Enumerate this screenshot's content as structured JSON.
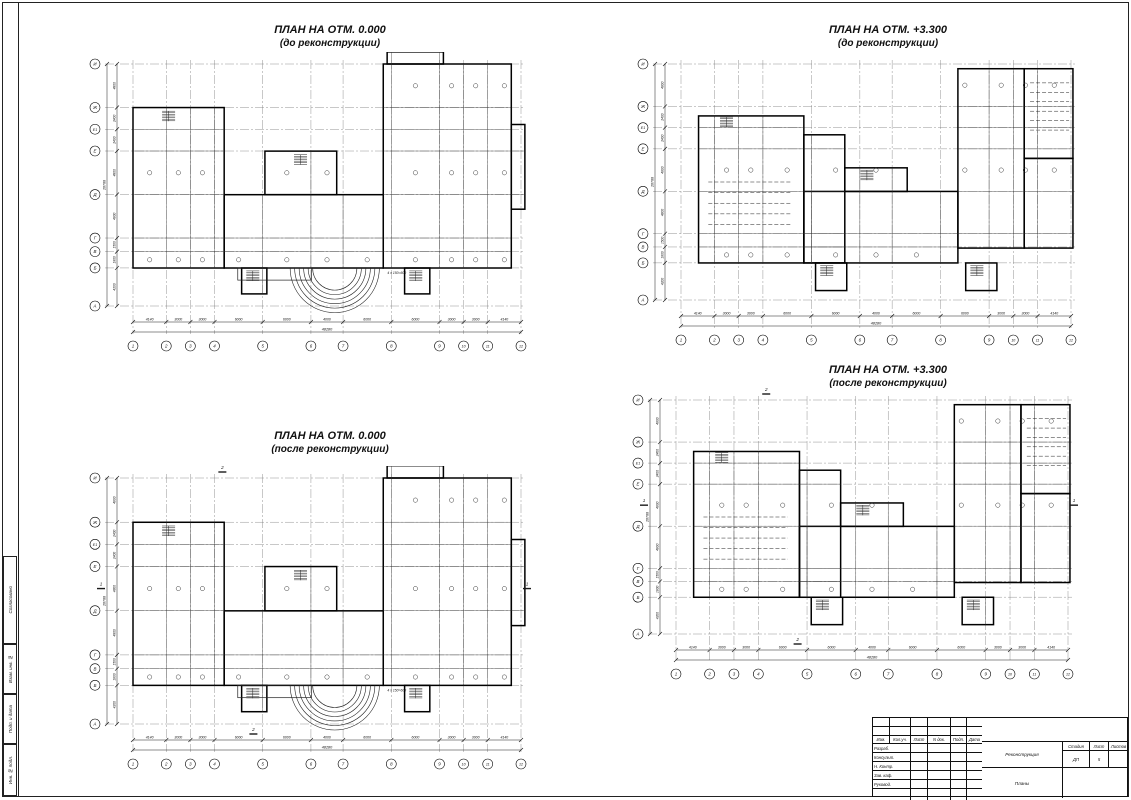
{
  "sheet": {
    "background": "#ffffff",
    "line_color": "#1a1a1a",
    "side_labels": [
      "Согласовано",
      "Взам. инв. №",
      "Подп. и дата",
      "Инв. № подл."
    ]
  },
  "plans": [
    {
      "title_line1": "ПЛАН НА ОТМ. 0.000",
      "title_line2": "(до реконструкции)"
    },
    {
      "title_line1": "ПЛАН НА ОТМ. +3.300",
      "title_line2": "(до реконструкции)"
    },
    {
      "title_line1": "ПЛАН НА ОТМ. 0.000",
      "title_line2": "(после реконструкции)"
    },
    {
      "title_line1": "ПЛАН НА ОТМ. +3.300",
      "title_line2": "(после реконструкции)"
    }
  ],
  "axes": {
    "columns": [
      "1",
      "2",
      "3",
      "4",
      "5",
      "6",
      "7",
      "8",
      "9",
      "10",
      "11",
      "12"
    ],
    "rows": [
      "И",
      "Ж",
      "Е1",
      "Е",
      "Д",
      "Г",
      "В",
      "Б",
      "А"
    ]
  },
  "dimensions": {
    "column_segments": [
      "4140",
      "3000",
      "3000",
      "6000",
      "6000",
      "4000",
      "6000",
      "6000",
      "3000",
      "3000",
      "4140"
    ],
    "total_width": "48280",
    "row_segments": [
      "4800",
      "2400",
      "2400",
      "4800",
      "4800",
      "1500",
      "1800",
      "4200"
    ],
    "total_height": "26700",
    "step_note": "4 х 150=600"
  },
  "section_marks": [
    "1",
    "2"
  ],
  "titleblock": {
    "header_cols": [
      "Изм.",
      "Кол.уч.",
      "Лист",
      "N док.",
      "Подп.",
      "Дата"
    ],
    "rows": [
      "Разраб.",
      "Консульт.",
      "Н. Контр.",
      "Зав. каф.",
      "Руковод.",
      ""
    ],
    "project": "Реконструкция",
    "doc_title": "Планы",
    "stage_label": "Стадия",
    "sheet_label": "Лист",
    "sheets_label": "Листов",
    "stage_value": "ДП",
    "sheet_value": "5",
    "sheets_value": ""
  }
}
